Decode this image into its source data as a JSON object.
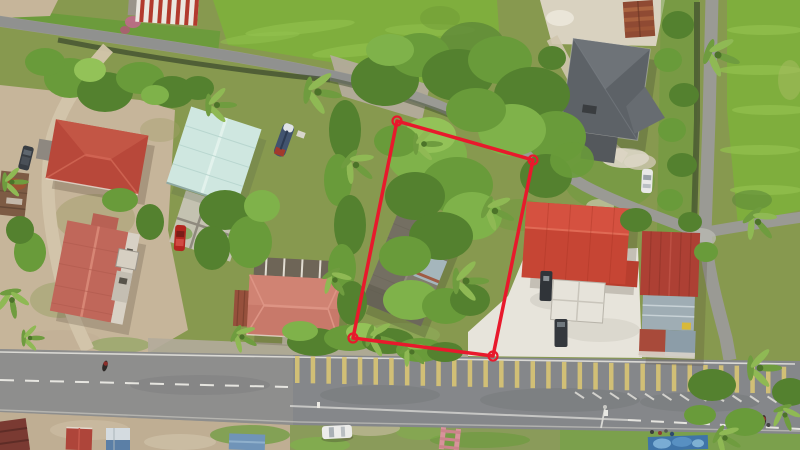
{
  "scene": {
    "type": "aerial-drone-photograph",
    "subject": "rural roadside village land lot with red surveyed boundary overlay",
    "text_visible": false
  },
  "boundary": {
    "color": "#e8192c",
    "stroke_width": 3.5,
    "marker_radius": 4.5,
    "marker_stroke_width": 2.2,
    "points": [
      [
        397,
        121
      ],
      [
        533,
        160
      ],
      [
        493,
        356
      ],
      [
        353,
        338
      ]
    ]
  },
  "road_markings": {
    "shoulder_hatch": {
      "count": 32,
      "x_start": 295,
      "spacing": 15.7,
      "y_base": 356,
      "slope": 0.022,
      "width": 4.5,
      "height": 27,
      "color": "#d9c573",
      "opacity": 0.9
    },
    "edge_chevrons": {
      "count": 13,
      "x_start": 575,
      "spacing": 17.5,
      "offset_y": 30,
      "dx": 9,
      "dy": 6,
      "color": "#e8e6e0",
      "opacity": 0.8
    },
    "center_dash_color": "#f0efe9"
  },
  "palette": {
    "boundary-red": "#e8192c",
    "hatch-yellow": "#d9c573",
    "lane-white": "#f0efe9",
    "road-gray": "#85878a",
    "road-light": "#9a9a94",
    "dirt-tan": "#c6b59a",
    "sand-white": "#e7e4db",
    "gravel": "#b3ab9b",
    "ground-grass": "#87994f",
    "paddy-green": "#7fae3d",
    "paddy-light": "#93c14f",
    "tree-dark": "#3f6428",
    "tree-mid": "#54812f",
    "tree-light": "#699b3a",
    "tree-bright": "#7fb24a",
    "tree-lush": "#93c258",
    "palm-a": "#6f9c3f",
    "palm-b": "#8fb954",
    "ditch-dark": "#3e4c2e",
    "roof-red-bright": "#c64534",
    "roof-red-left": "#b8483a",
    "roof-salmon-long": "#c0675a",
    "roof-pink-house": "#c8796a",
    "roof-gray-house": "#5d6267",
    "roof-cyan": "#cfe7e0",
    "roof-old-weathered": "#817c6e",
    "roof-shop-red": "#ad4034",
    "roof-shop-bluegray": "#9fadb4"
  }
}
